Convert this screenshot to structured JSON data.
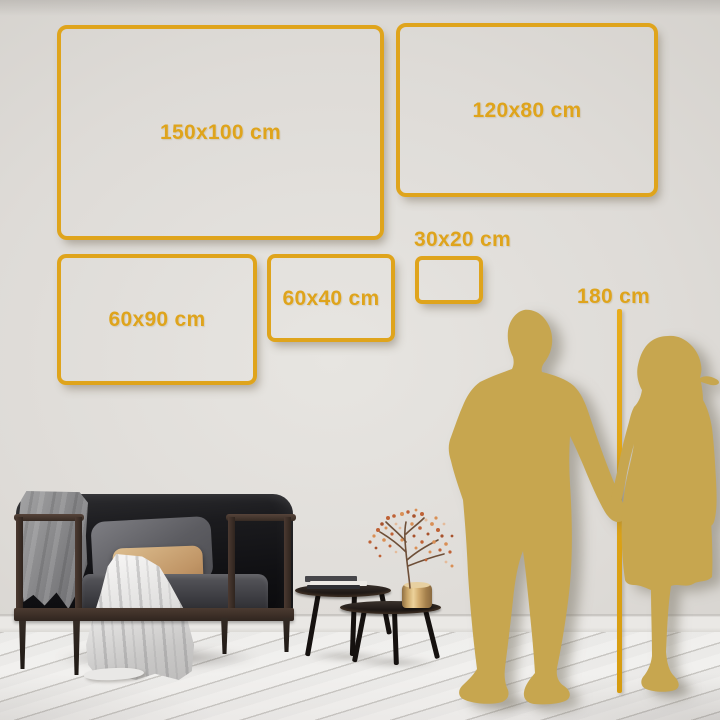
{
  "size_guide": {
    "frames": [
      {
        "label": "150x100 cm"
      },
      {
        "label": "120x80 cm"
      },
      {
        "label": "60x90 cm"
      },
      {
        "label": "60x40 cm"
      },
      {
        "label": "30x20 cm"
      }
    ],
    "height_marker": {
      "label": "180 cm"
    }
  },
  "colors": {
    "accent_gold": "#DFA41C",
    "ruler_gold": "#D69C10",
    "silhouette_gold": "#C7A64F",
    "wall": "#DEDBD7",
    "floor": "#F1F0EE",
    "pillow_tan": "#DDBE8F",
    "vase_brass": "#D4AF72"
  },
  "figures": {
    "man": "man-silhouette",
    "woman": "woman-silhouette"
  }
}
